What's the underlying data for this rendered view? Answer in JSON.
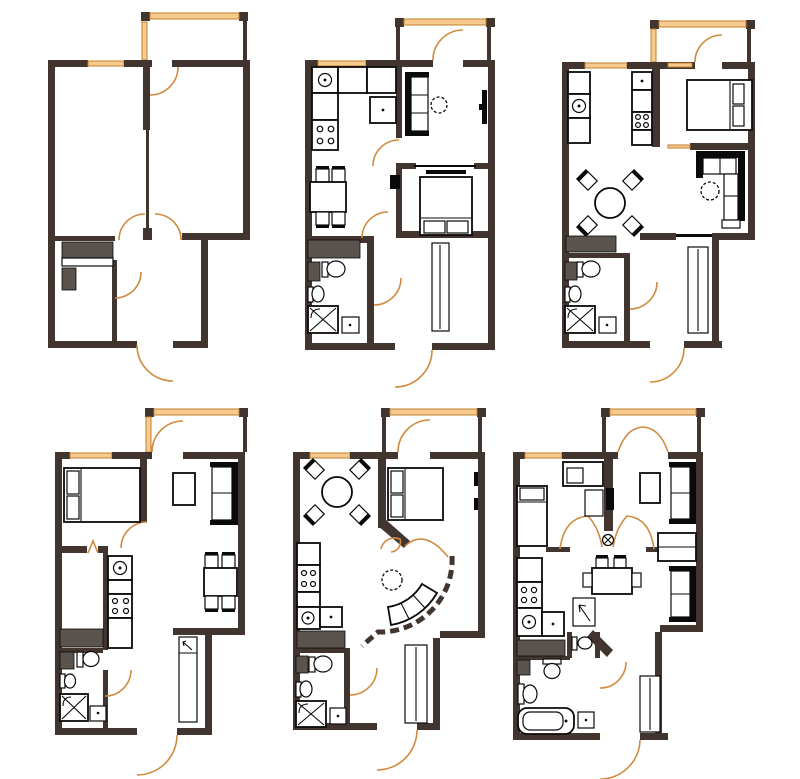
{
  "figure": {
    "label": "Six apartment floor plans, two rows of three",
    "type": "floor-plan-collage",
    "rows": 2,
    "cols": 3
  },
  "colors": {
    "wall": "#42342f",
    "window": "#f7cb90",
    "window_edge": "#bf7f2c",
    "door": "#d08a3e",
    "line": "#0a0a0a",
    "gray": "#5a534e",
    "background": "#ffffff"
  },
  "plans": [
    {
      "name": "plan-1-top-left",
      "position": "top-left",
      "rooms": [
        "room-left",
        "room-right",
        "hallway",
        "storage"
      ],
      "features": [
        "balcony",
        "window",
        "entry-door-arc",
        "interior-door-arcs"
      ],
      "furniture": [
        "wardrobe-cabinet",
        "low-cabinet"
      ]
    },
    {
      "name": "plan-2-top-middle",
      "position": "top-middle",
      "rooms": [
        "kitchen",
        "living-room",
        "bedroom",
        "bathroom",
        "hallway"
      ],
      "features": [
        "balcony",
        "window",
        "entry-door-arc",
        "interior-door-arcs"
      ],
      "furniture": [
        "kitchen-counter-with-sink",
        "stove",
        "dining-table-4-chairs",
        "sofa",
        "round-side-table",
        "tv",
        "double-bed",
        "cabinet",
        "toilet",
        "washbasin",
        "corner-shower",
        "wardrobe"
      ]
    },
    {
      "name": "plan-3-top-right",
      "position": "top-right",
      "rooms": [
        "kitchen",
        "living-dining-room",
        "bedroom",
        "bathroom",
        "hallway"
      ],
      "features": [
        "balcony",
        "window",
        "entry-door-arc",
        "interior-door-arcs"
      ],
      "furniture": [
        "kitchen-counters",
        "sink",
        "stove",
        "round-dining-table-4-chairs",
        "corner-sofa",
        "round-side-table",
        "double-bed",
        "cabinet",
        "toilet",
        "washbasin",
        "corner-shower",
        "wardrobe"
      ]
    },
    {
      "name": "plan-4-bottom-left",
      "position": "bottom-left",
      "rooms": [
        "bedroom",
        "living-dining-room",
        "kitchen",
        "bathroom",
        "hallway"
      ],
      "features": [
        "balcony",
        "window",
        "entry-door-arc",
        "interior-door-arcs"
      ],
      "furniture": [
        "double-bed",
        "sofa",
        "coffee-table",
        "dining-table-4-chairs",
        "kitchen-counter-sink-stove",
        "cabinet",
        "toilet",
        "washbasin",
        "corner-shower",
        "wardrobe-with-hook"
      ]
    },
    {
      "name": "plan-5-bottom-middle",
      "position": "bottom-middle",
      "rooms": [
        "dining-area",
        "bedroom",
        "curved-living-area",
        "kitchen",
        "bathroom",
        "hallway"
      ],
      "features": [
        "balcony",
        "window",
        "curved-partition-wall",
        "entry-door-arc",
        "interior-door-arcs"
      ],
      "furniture": [
        "round-dining-table-4-chairs",
        "double-bed",
        "tv",
        "curved-sofa",
        "round-side-table",
        "kitchen-counter-sink-stove",
        "cabinet",
        "toilet",
        "washbasin",
        "corner-shower",
        "wardrobe"
      ]
    },
    {
      "name": "plan-6-bottom-right",
      "position": "bottom-right",
      "rooms": [
        "bedroom",
        "living-room",
        "dining-area",
        "kitchen",
        "bathroom",
        "wc",
        "hallway"
      ],
      "features": [
        "balcony",
        "french-balcony-doors",
        "window",
        "fan-of-door-swings",
        "entry-door-arc"
      ],
      "furniture": [
        "bed",
        "desk",
        "shelf",
        "sofa",
        "second-sofa",
        "side-table",
        "wall-cabinet",
        "dining-table-chairs",
        "kitchen-counter-sink-stove",
        "cabinet",
        "wc-toilet",
        "toilet",
        "washbasin",
        "bathtub",
        "dot-stand",
        "wardrobe",
        "direction-arrow-card"
      ]
    }
  ]
}
